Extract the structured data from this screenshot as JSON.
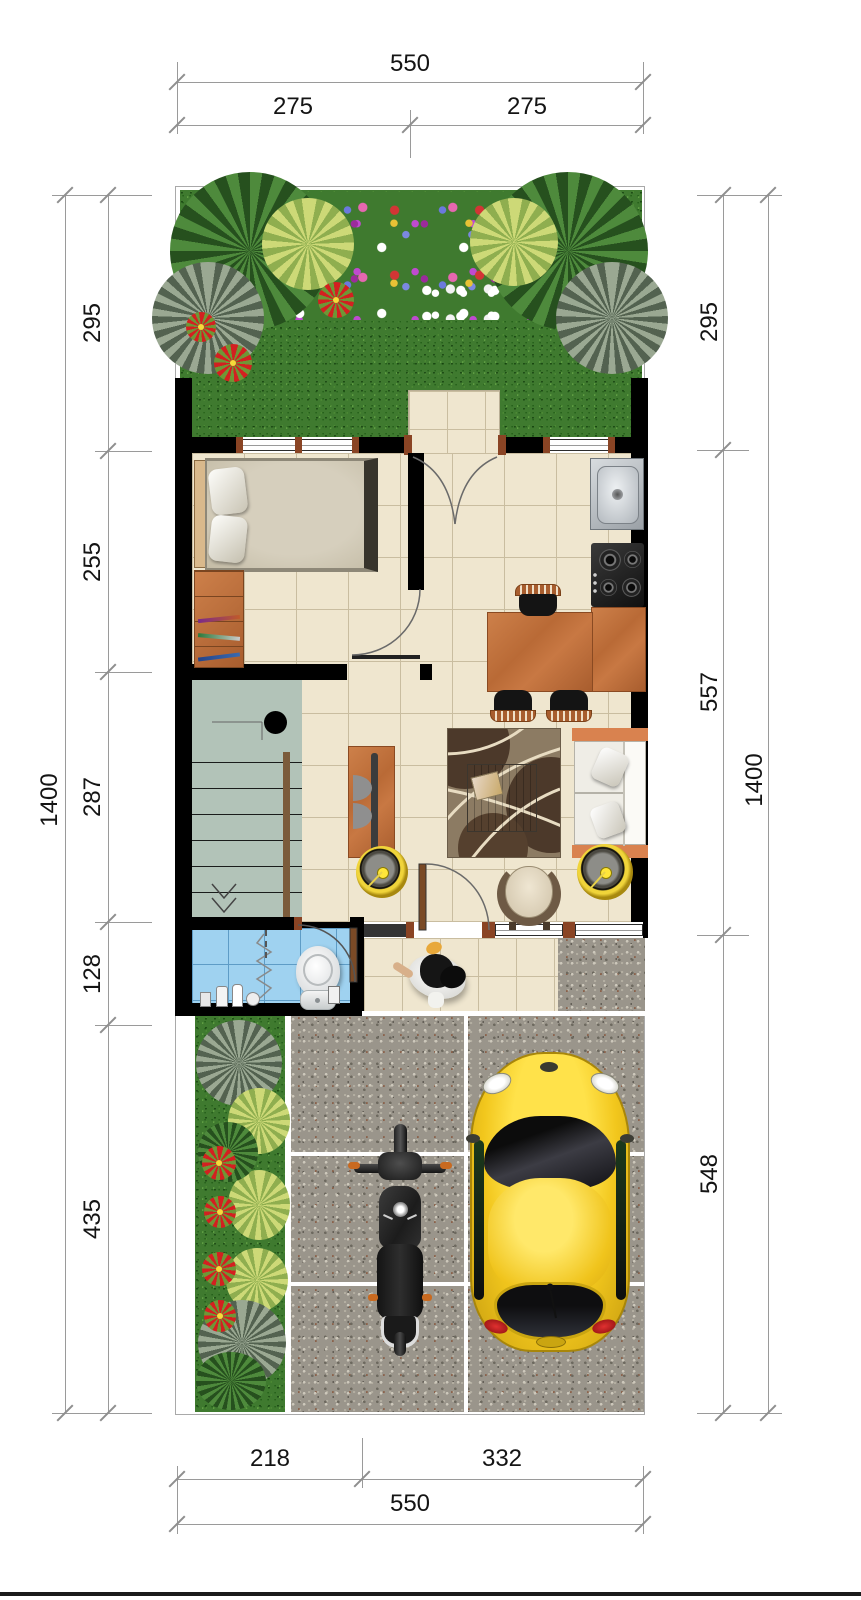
{
  "drawing": "house-floor-plan",
  "dimensions": {
    "top": {
      "total": "550",
      "left_segment": "275",
      "right_segment": "275"
    },
    "left_side": {
      "segments": [
        "295",
        "255",
        "287",
        "128",
        "435"
      ],
      "total": "1400"
    },
    "right_side": {
      "segments": [
        "295",
        "557",
        "548"
      ],
      "total": "1400"
    },
    "bottom": {
      "segments": [
        "218",
        "332"
      ],
      "total": "550"
    }
  },
  "colors": {
    "wall": "#000000",
    "floor": "#efe6cf",
    "bath": "#9fd2f0",
    "grass": "#3f7a2f",
    "gravel": "#9a958b",
    "stairs": "#b2c3b8",
    "wood": "#c0703c",
    "sofa_accent": "#d9824f",
    "car": "#f2c71d",
    "gold": "#e4c028"
  }
}
